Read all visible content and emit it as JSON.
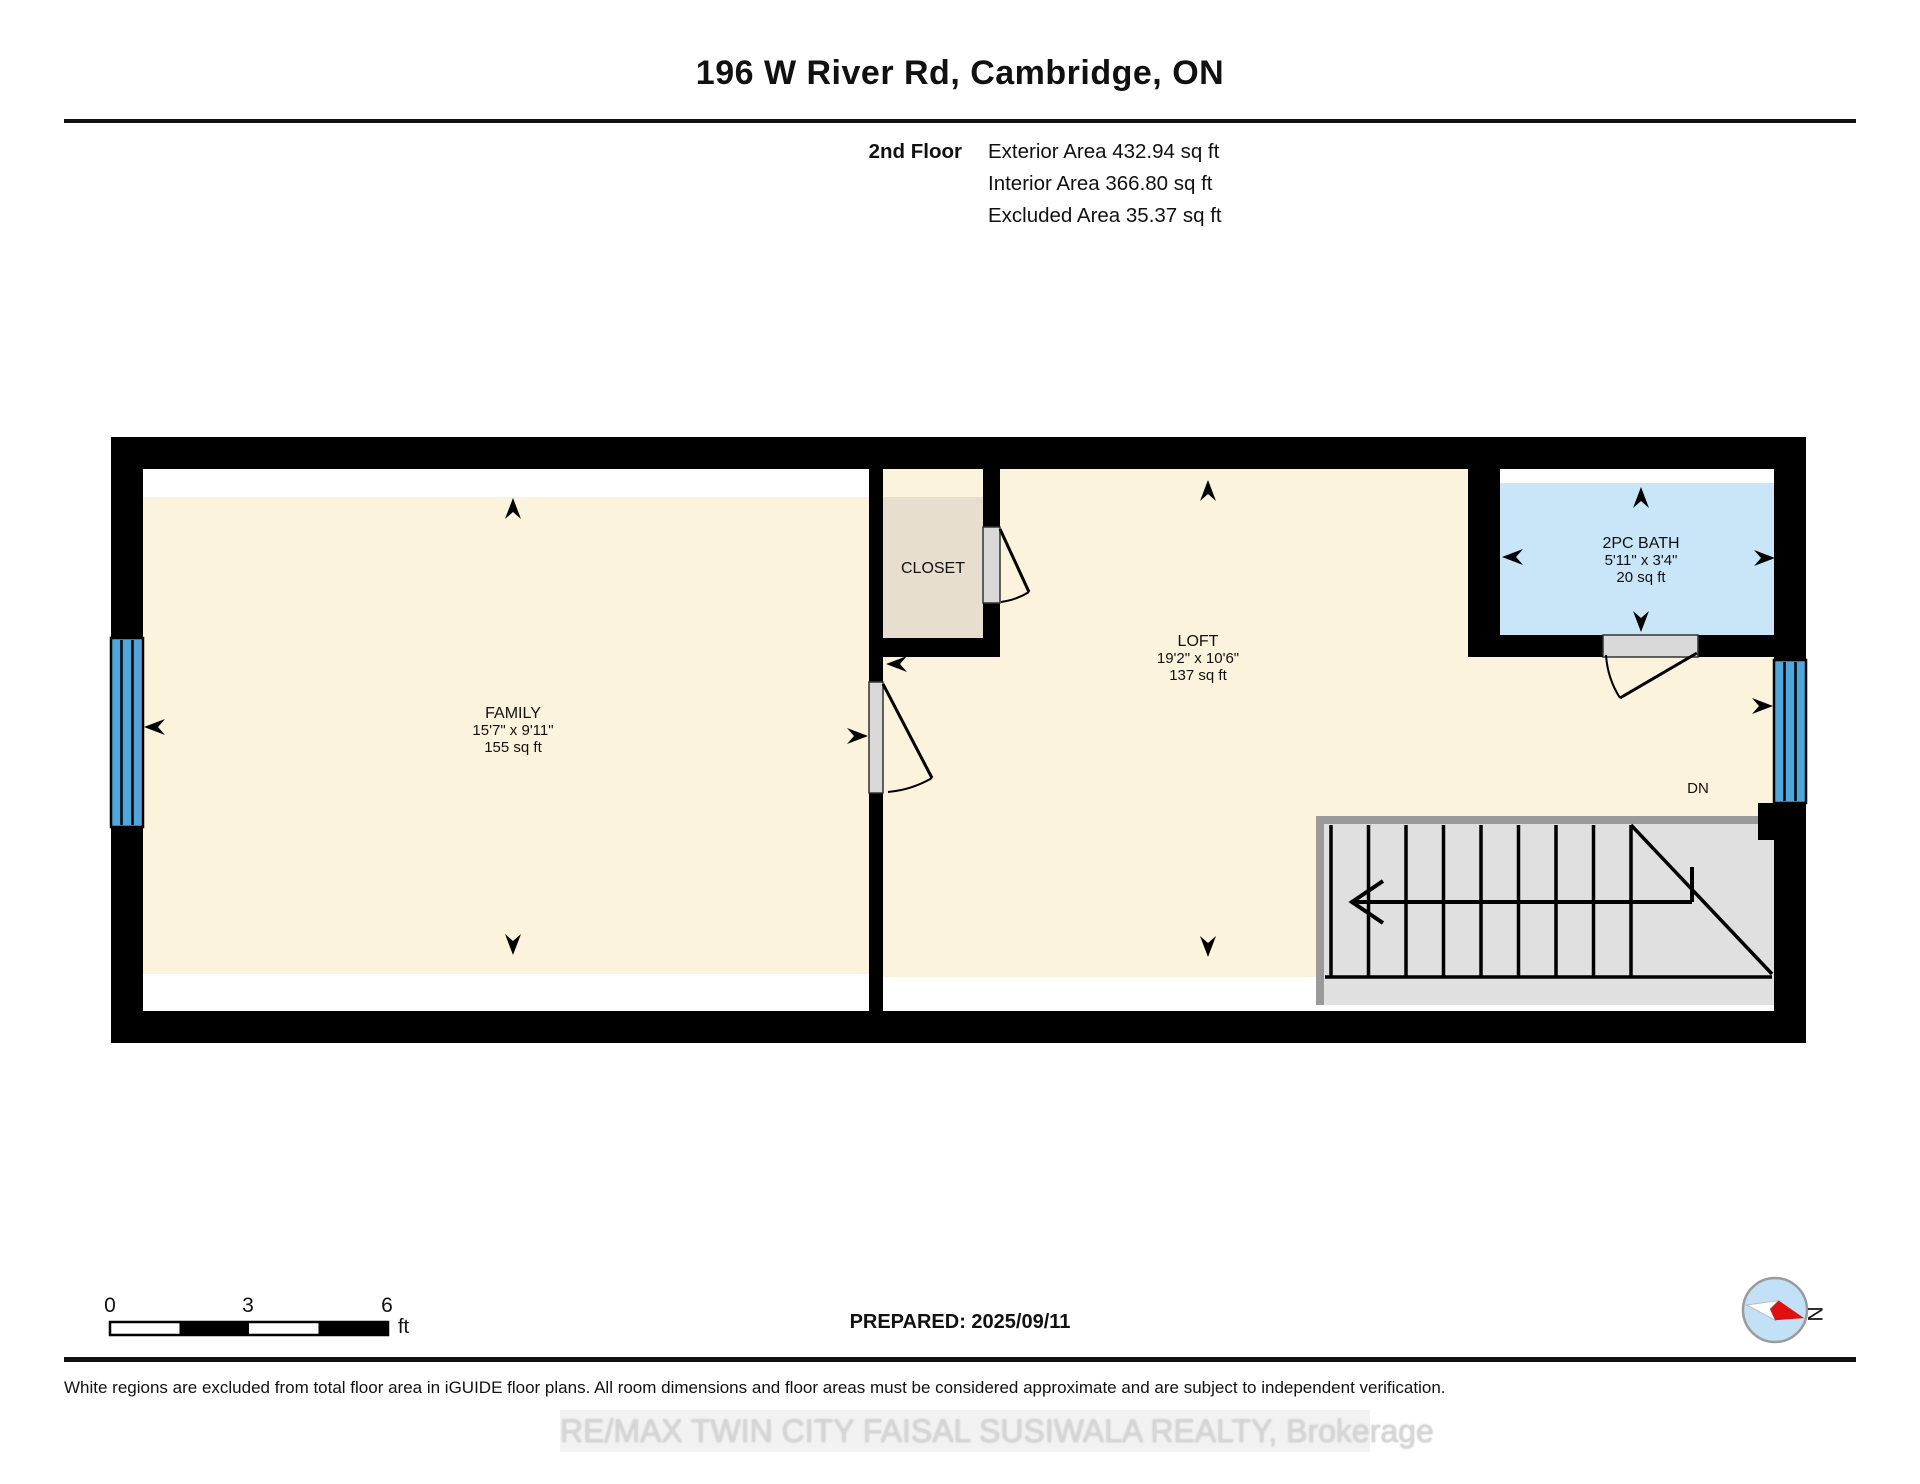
{
  "header": {
    "title": "196 W River Rd, Cambridge, ON",
    "floor_label": "2nd Floor",
    "area_rows": [
      "Exterior Area 432.94 sq ft",
      "Interior Area 366.80 sq ft",
      "Excluded Area 35.37 sq ft"
    ]
  },
  "rooms": {
    "family": {
      "name": "FAMILY",
      "dims": "15'7\" x 9'11\"",
      "area": "155 sq ft"
    },
    "closet": {
      "name": "CLOSET"
    },
    "loft": {
      "name": "LOFT",
      "dims": "19'2\" x 10'6\"",
      "area": "137 sq ft"
    },
    "bath": {
      "name": "2PC BATH",
      "dims": "5'11\" x 3'4\"",
      "area": "20 sq ft"
    },
    "stairs_label": "DN"
  },
  "scale_bar": {
    "start": "0",
    "mid": "3",
    "end": "6",
    "unit": "ft"
  },
  "compass": {
    "north_label": "N"
  },
  "footer": {
    "prepared": "PREPARED: 2025/09/11",
    "disclaimer": "White regions are excluded from total floor area in iGUIDE floor plans. All room dimensions and floor areas must be considered approximate and are subject to independent verification.",
    "watermark": "RE/MAX TWIN CITY FAISAL SUSIWALA REALTY, Brokerage"
  },
  "colors": {
    "floor_cream": "#FBF3DC",
    "closet_tan": "#E7DED0",
    "bath_blue": "#C9E5F8",
    "window_blue": "#4FA7DB",
    "stairs_gray": "#E0E0E0",
    "stairs_border_gray": "#9A9A9A",
    "door_gray": "#D9D9D9",
    "wall_black": "#000000",
    "compass_red": "#E01010",
    "compass_fill_blue": "#C2E0F6",
    "watermark_gray": "#D6D6D6"
  }
}
